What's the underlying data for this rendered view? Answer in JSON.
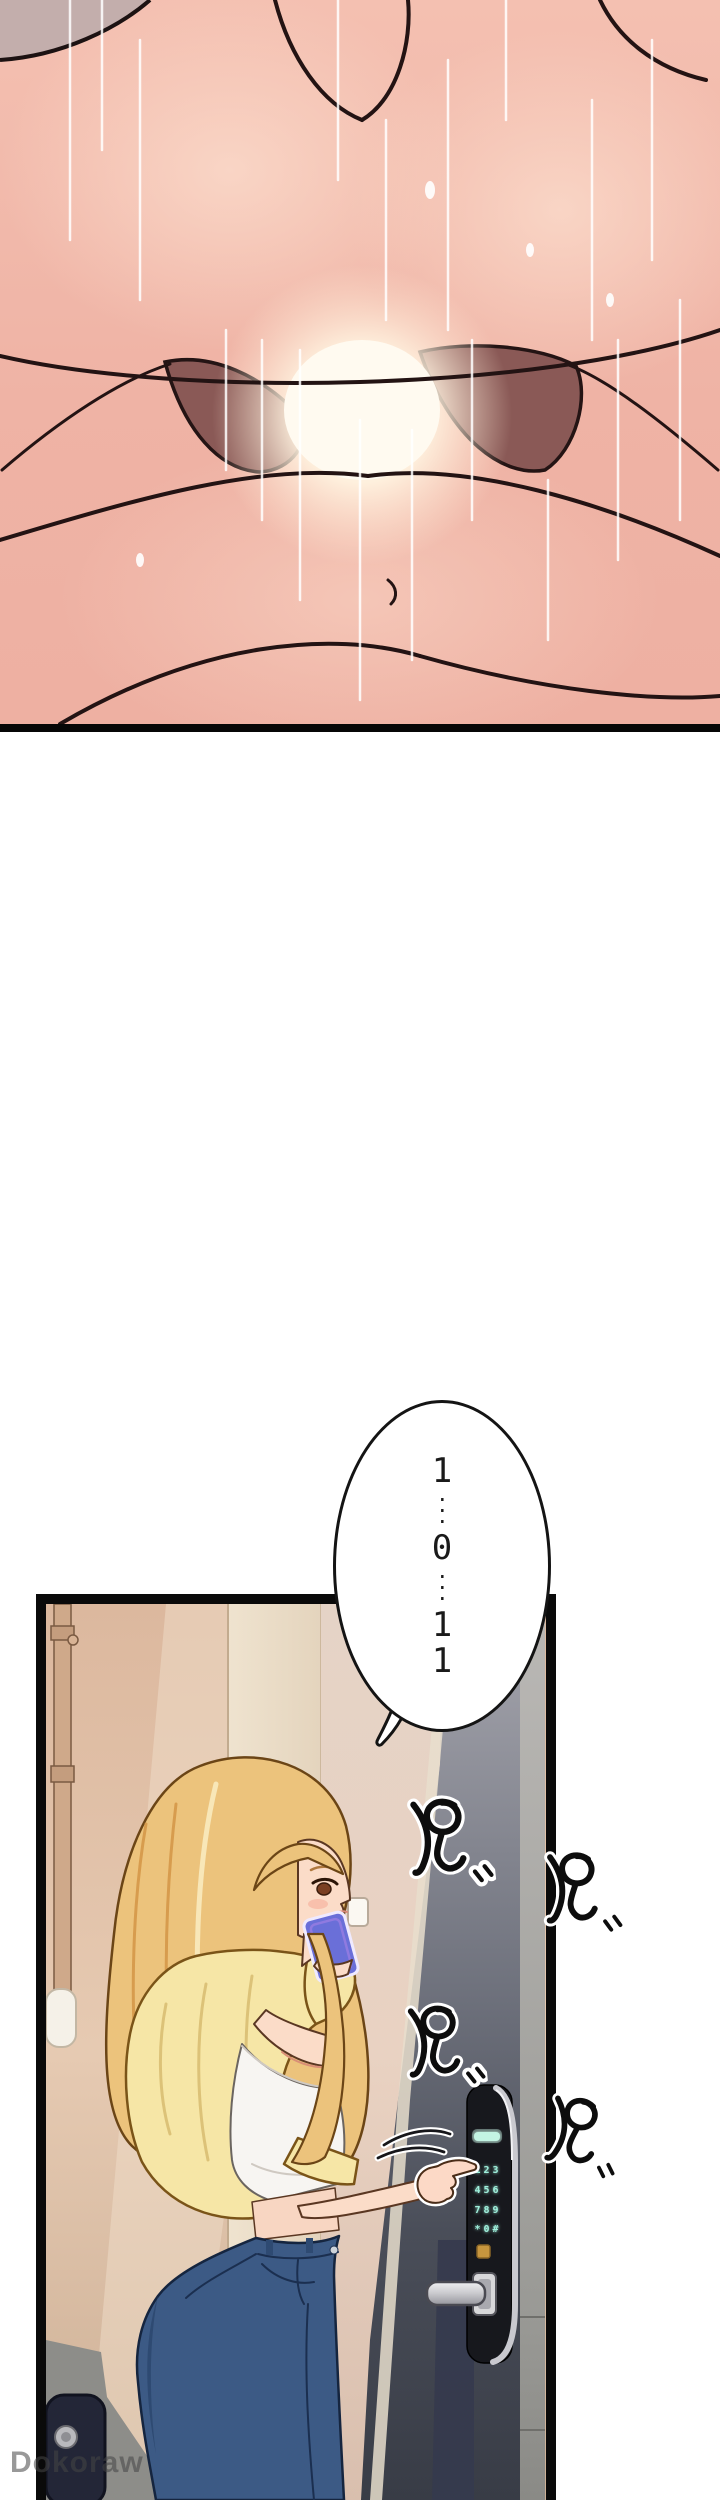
{
  "page": {
    "kind": "webtoon comic page",
    "width_px": 720,
    "height_px": 2500,
    "background": "#ffffff"
  },
  "top_panel": {
    "description": "full-bleed close-up artwork panel (abstracted)",
    "border_color": "#070707"
  },
  "speech_bubble": {
    "digits": [
      "1",
      "···",
      "0",
      "···",
      "1",
      "1"
    ],
    "reading": "1...0...11"
  },
  "sfx": {
    "char": "ピ",
    "count": 4
  },
  "scene": {
    "door_lock": {
      "keypad_rows": [
        "123",
        "456",
        "789",
        "*0#"
      ],
      "glow_color": "#9ff0dc"
    }
  },
  "watermark": {
    "text": "Dokoraw"
  },
  "colors": {
    "panel_border": "#0a0a0a",
    "skin": "#fbdcc8",
    "hair": "#ecc37c",
    "cardigan": "#f6e6a6",
    "jeans": "#3c5a85",
    "lock_body": "#17181d",
    "keypad_glow": "#9ff0dc",
    "wall_beige": "#dfc0a8",
    "door_gray": "#4a4e59"
  }
}
